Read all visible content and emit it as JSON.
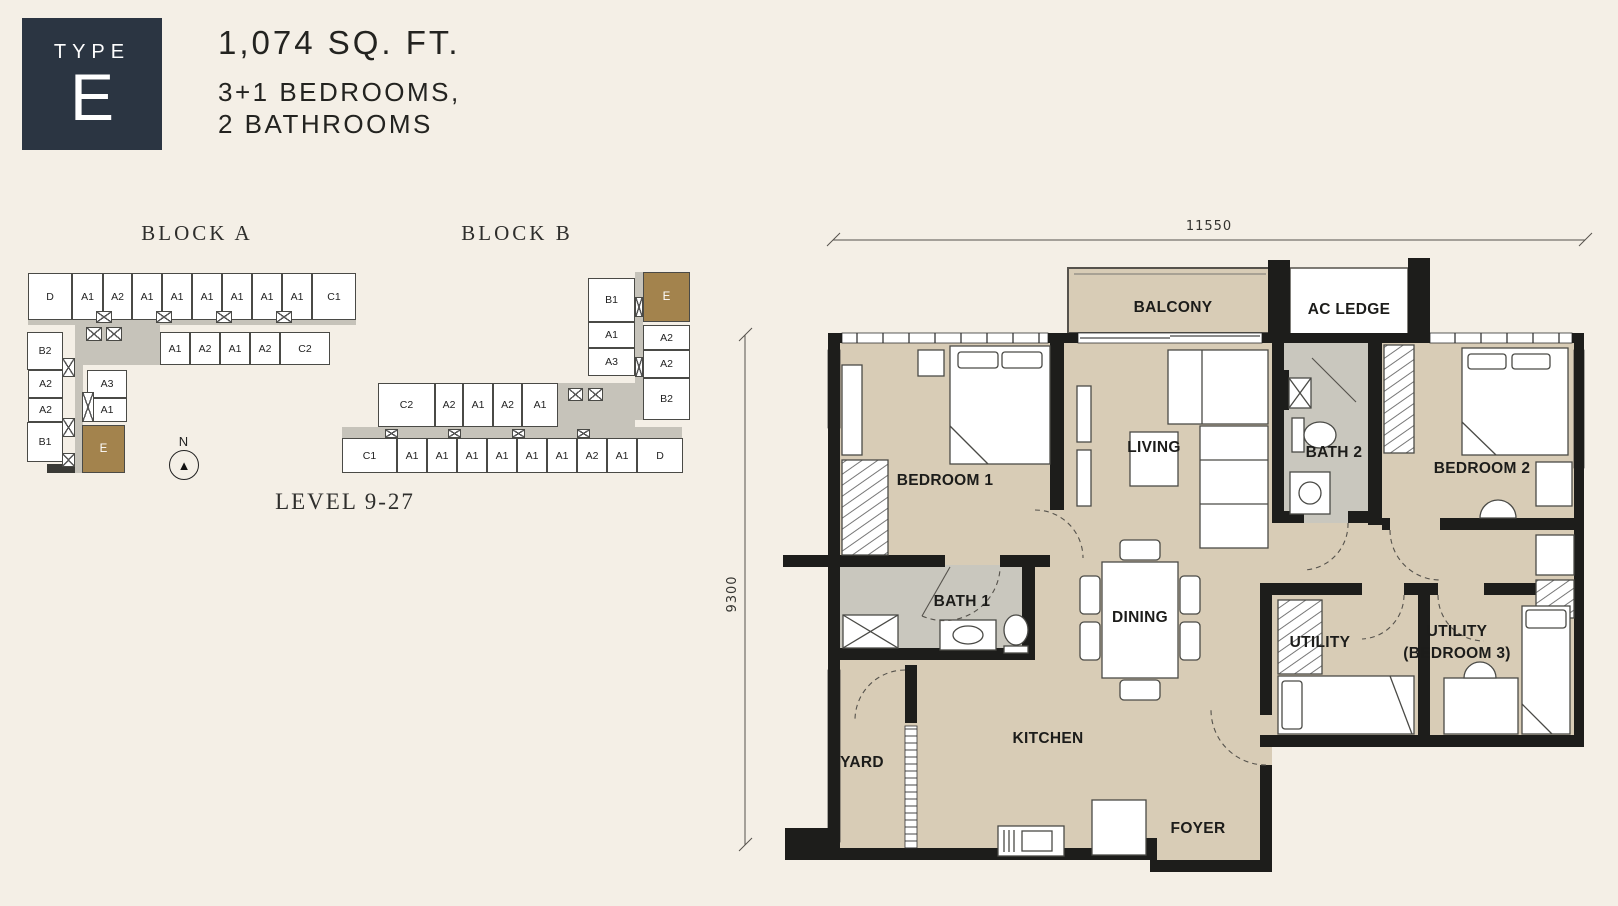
{
  "header": {
    "type_label": "TYPE",
    "type_letter": "E",
    "area": "1,074 SQ. FT.",
    "bedrooms_line": "3+1 BEDROOMS,",
    "bathrooms_line": "2 BATHROOMS"
  },
  "site": {
    "level_label": "LEVEL 9-27",
    "north_label": "N",
    "north_arrow_icon": "compass-arrow",
    "highlight_color": "#a3834d",
    "block_a": {
      "title": "BLOCK A",
      "cells": [
        [
          8,
          11,
          44,
          47,
          "D"
        ],
        [
          52,
          11,
          31,
          47,
          "A1"
        ],
        [
          83,
          11,
          29,
          47,
          "A2"
        ],
        [
          112,
          11,
          30,
          47,
          "A1"
        ],
        [
          142,
          11,
          30,
          47,
          "A1"
        ],
        [
          172,
          11,
          30,
          47,
          "A1"
        ],
        [
          202,
          11,
          30,
          47,
          "A1"
        ],
        [
          232,
          11,
          30,
          47,
          "A1"
        ],
        [
          262,
          11,
          30,
          47,
          "A1"
        ],
        [
          292,
          11,
          44,
          47,
          "C1"
        ],
        [
          140,
          70,
          30,
          33,
          "A1"
        ],
        [
          170,
          70,
          30,
          33,
          "A2"
        ],
        [
          200,
          70,
          30,
          33,
          "A1"
        ],
        [
          230,
          70,
          30,
          33,
          "A2"
        ],
        [
          260,
          70,
          50,
          33,
          "C2"
        ],
        [
          7,
          70,
          36,
          38,
          "B2"
        ],
        [
          8,
          108,
          35,
          28,
          "A2"
        ],
        [
          8,
          136,
          35,
          24,
          "A2"
        ],
        [
          7,
          160,
          36,
          40,
          "B1"
        ],
        [
          67,
          108,
          40,
          28,
          "A3"
        ],
        [
          67,
          136,
          40,
          24,
          "A1"
        ],
        [
          62,
          163,
          43,
          48,
          "E",
          1
        ]
      ],
      "corridors": [
        [
          8,
          55,
          328,
          8
        ],
        [
          60,
          61,
          80,
          42
        ],
        [
          55,
          63,
          8,
          148
        ],
        [
          27,
          202,
          28,
          9,
          1
        ]
      ],
      "shafts": [
        [
          76,
          49,
          16,
          12
        ],
        [
          136,
          49,
          16,
          12
        ],
        [
          196,
          49,
          16,
          12
        ],
        [
          256,
          49,
          16,
          12
        ],
        [
          66,
          65,
          16,
          14
        ],
        [
          86,
          65,
          16,
          14
        ],
        [
          42,
          96,
          13,
          19
        ],
        [
          42,
          156,
          13,
          19
        ],
        [
          62,
          130,
          12,
          30
        ],
        [
          42,
          191,
          13,
          14
        ]
      ]
    },
    "block_b": {
      "title": "BLOCK B",
      "cells": [
        [
          258,
          26,
          47,
          44,
          "B1"
        ],
        [
          313,
          20,
          47,
          50,
          "E",
          1
        ],
        [
          258,
          70,
          47,
          26,
          "A1"
        ],
        [
          313,
          73,
          47,
          25,
          "A2"
        ],
        [
          258,
          96,
          47,
          28,
          "A3"
        ],
        [
          313,
          98,
          47,
          28,
          "A2"
        ],
        [
          313,
          126,
          47,
          42,
          "B2"
        ],
        [
          48,
          131,
          57,
          44,
          "C2"
        ],
        [
          105,
          131,
          28,
          44,
          "A2"
        ],
        [
          133,
          131,
          30,
          44,
          "A1"
        ],
        [
          163,
          131,
          29,
          44,
          "A2"
        ],
        [
          192,
          131,
          36,
          44,
          "A1"
        ],
        [
          12,
          186,
          55,
          35,
          "C1"
        ],
        [
          67,
          186,
          30,
          35,
          "A1"
        ],
        [
          97,
          186,
          30,
          35,
          "A1"
        ],
        [
          127,
          186,
          30,
          35,
          "A1"
        ],
        [
          157,
          186,
          30,
          35,
          "A1"
        ],
        [
          187,
          186,
          30,
          35,
          "A1"
        ],
        [
          217,
          186,
          30,
          35,
          "A1"
        ],
        [
          247,
          186,
          30,
          35,
          "A2"
        ],
        [
          277,
          186,
          30,
          35,
          "A1"
        ],
        [
          307,
          186,
          46,
          35,
          "D"
        ]
      ],
      "corridors": [
        [
          305,
          20,
          8,
          148
        ],
        [
          228,
          131,
          77,
          44
        ],
        [
          12,
          175,
          340,
          11
        ]
      ],
      "shafts": [
        [
          55,
          177,
          13,
          9
        ],
        [
          118,
          177,
          13,
          9
        ],
        [
          182,
          177,
          13,
          9
        ],
        [
          247,
          177,
          13,
          9
        ],
        [
          238,
          136,
          15,
          13
        ],
        [
          258,
          136,
          15,
          13
        ],
        [
          305,
          45,
          8,
          20
        ],
        [
          305,
          105,
          8,
          20
        ]
      ]
    }
  },
  "floorplan": {
    "dim_width": "11550",
    "dim_height": "9300",
    "labels": {
      "balcony": "BALCONY",
      "ac_ledge": "AC LEDGE",
      "living": "LIVING",
      "bath2": "BATH 2",
      "bedroom2": "BEDROOM 2",
      "bedroom1": "BEDROOM 1",
      "bath1": "BATH 1",
      "dining": "DINING",
      "utility": "UTILITY",
      "utility3_l1": "UTILITY",
      "utility3_l2": "(BEDROOM 3)",
      "yard": "YARD",
      "kitchen": "KITCHEN",
      "foyer": "FOYER"
    },
    "colors": {
      "floor_tan": "#d8ccb6",
      "wet_gray": "#c9c7be",
      "wall": "#1d1d1b",
      "background": "#f4efe6"
    }
  }
}
